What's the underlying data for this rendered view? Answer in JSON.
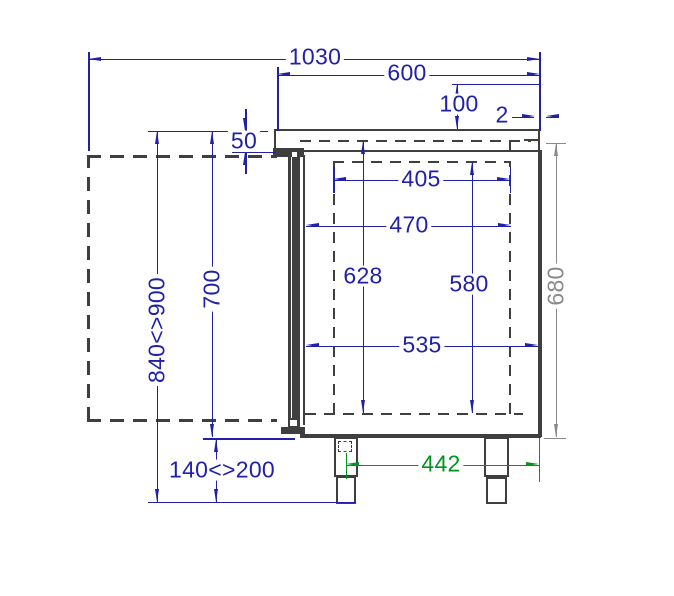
{
  "drawing": {
    "type": "technical-cad-side-section",
    "subject": "refrigerated counter side cross-section with dimensions",
    "units": "mm",
    "colors": {
      "dimension": "#2121a8",
      "alt_dimension": "#8a8a8a",
      "highlight_dimension": "#00961e",
      "structure": "#3f3f3f",
      "background": "#ffffff"
    },
    "dimensions": [
      {
        "id": "total-depth-door-open",
        "label": "1030"
      },
      {
        "id": "body-depth",
        "label": "600"
      },
      {
        "id": "upstand-height",
        "label": "100"
      },
      {
        "id": "back-edge-gap",
        "label": "2"
      },
      {
        "id": "worktop-thickness",
        "label": "50"
      },
      {
        "id": "interior-width-upper",
        "label": "405"
      },
      {
        "id": "interior-width-mid",
        "label": "470"
      },
      {
        "id": "interior-height-front",
        "label": "628"
      },
      {
        "id": "interior-height-back",
        "label": "580"
      },
      {
        "id": "interior-width-lower",
        "label": "535"
      },
      {
        "id": "body-height",
        "label": "700"
      },
      {
        "id": "working-height-range",
        "label": "840<>900"
      },
      {
        "id": "leg-height-range",
        "label": "140<>200"
      },
      {
        "id": "leg-spacing",
        "label": "442"
      },
      {
        "id": "side-panel-height",
        "label": "680"
      }
    ]
  }
}
